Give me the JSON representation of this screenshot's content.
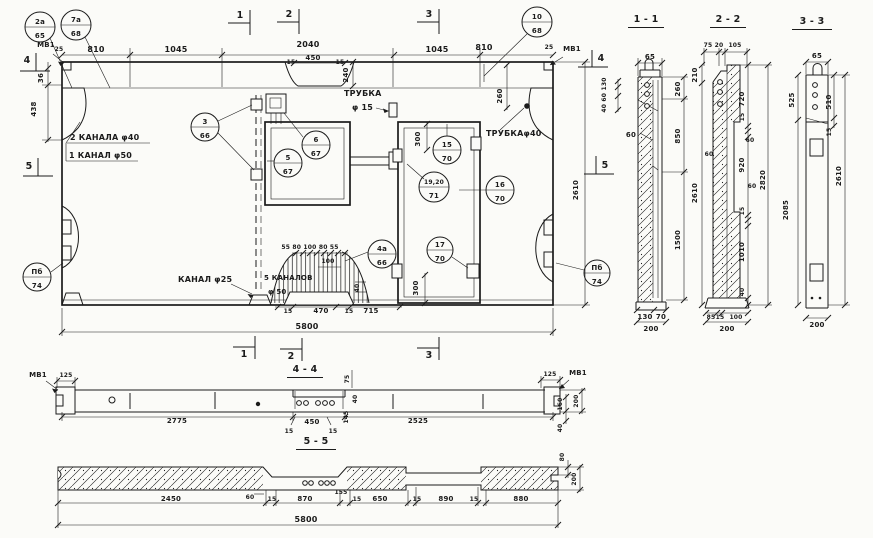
{
  "plan": {
    "marks": {
      "m1": "1",
      "m2": "2",
      "m3": "3",
      "m4": "4",
      "m5": "5"
    },
    "top_dims": [
      "25",
      "810",
      "1045",
      "2040",
      "1045",
      "810",
      "25"
    ],
    "notch_dims": [
      "15",
      "450",
      "15"
    ],
    "vdims": {
      "v240": "240",
      "v260": "260",
      "v36": "36",
      "v438": "438",
      "v2610": "2610",
      "v300t": "300",
      "v300b": "300",
      "v40": "40",
      "v100": "100"
    },
    "fan_row": "55 80 100 80 55",
    "labels": {
      "mv1": "МВ1",
      "kanala2": "2 КАНАЛА φ40",
      "kanal1": "1 КАНАЛ φ50",
      "trubka": "ТРУБКА",
      "f15": "φ 15",
      "trubka40": "ТРУБКАφ40",
      "kanal25": "КАНАЛ φ25",
      "kanalov5": "5 КАНАЛОВ",
      "f50": "φ 50"
    },
    "bottom_dims": [
      "15",
      "470",
      "15",
      "715"
    ],
    "overall": "5800",
    "callouts": [
      {
        "t": "2а",
        "b": "65"
      },
      {
        "t": "7а",
        "b": "68"
      },
      {
        "t": "10",
        "b": "68"
      },
      {
        "t": "3",
        "b": "66"
      },
      {
        "t": "6",
        "b": "67"
      },
      {
        "t": "5",
        "b": "67"
      },
      {
        "t": "15",
        "b": "70"
      },
      {
        "t": "19,20",
        "b": "71"
      },
      {
        "t": "16",
        "b": "70"
      },
      {
        "t": "17",
        "b": "70"
      },
      {
        "t": "4а",
        "b": "66"
      },
      {
        "t": "Пб",
        "b": "74"
      },
      {
        "t": "Пб",
        "b": "74"
      }
    ]
  },
  "s11": {
    "title": "1 - 1",
    "w65": "65",
    "stack": "40 60 130",
    "d60": "60",
    "right": [
      "260",
      "850",
      "1500"
    ],
    "bottom": [
      "130",
      "70",
      "200"
    ]
  },
  "s22": {
    "title": "2 - 2",
    "top": [
      "75",
      "20",
      "105"
    ],
    "left": [
      "210",
      "2610"
    ],
    "right": [
      "720",
      "15",
      "60",
      "920",
      "60",
      "15",
      "1010",
      "40"
    ],
    "d60": "60",
    "outer": "2820",
    "bottom": [
      "85",
      "15",
      "100",
      "200"
    ]
  },
  "s33": {
    "title": "3 - 3",
    "w65": "65",
    "left": [
      "525",
      "2085"
    ],
    "right": [
      "510",
      "15",
      "2610"
    ],
    "bottom": "200"
  },
  "s44": {
    "title": "4 - 4",
    "mv1_l": "МВ1",
    "mv1_r": "МВ1",
    "d125_l": "125",
    "d125_r": "125",
    "d2775": "2775",
    "stack": [
      "75",
      "40",
      "145"
    ],
    "mid": [
      "15",
      "450",
      "15"
    ],
    "d2525": "2525",
    "right": [
      "160",
      "200",
      "40"
    ]
  },
  "s55": {
    "title": "5 - 5",
    "dims": [
      "2450",
      "60",
      "15",
      "870",
      "155",
      "15",
      "650",
      "15",
      "890",
      "15",
      "880"
    ],
    "right": [
      "80",
      "200"
    ],
    "overall": "5800"
  }
}
